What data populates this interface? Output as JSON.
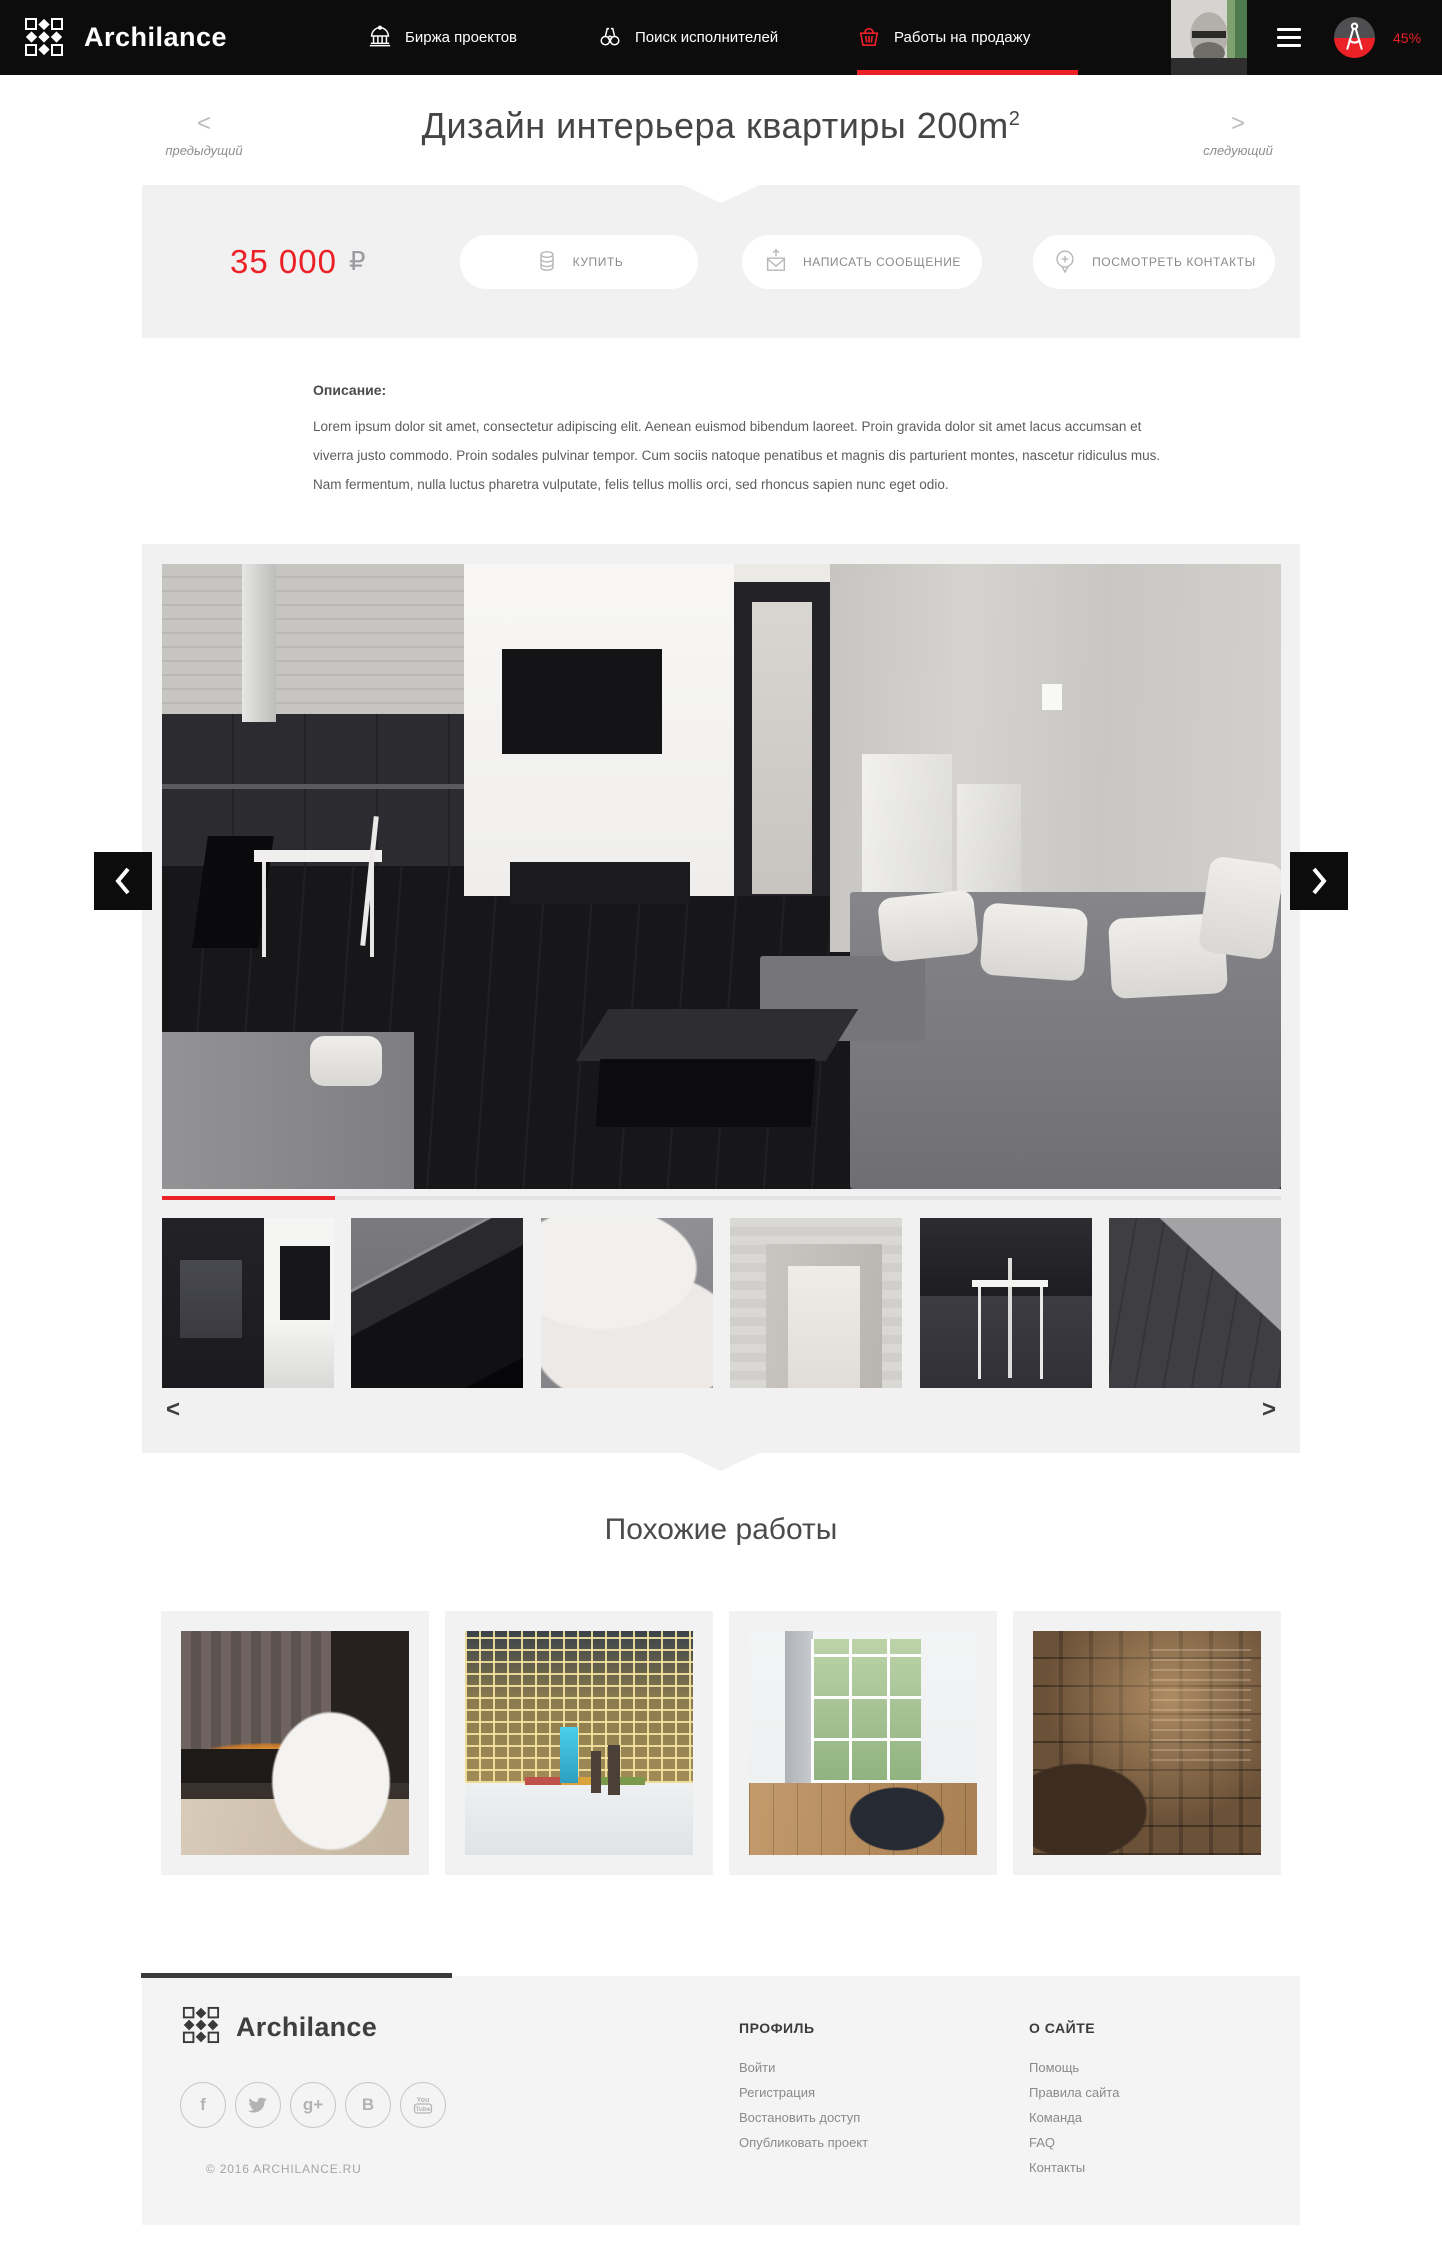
{
  "brand": {
    "name": "Archilance"
  },
  "navbar": {
    "items": [
      {
        "label": "Биржа проектов"
      },
      {
        "label": "Поиск исполнителей"
      },
      {
        "label": "Работы на продажу"
      }
    ],
    "percent": "45%"
  },
  "titlebar": {
    "title": "Дизайн интерьера квартиры 200m",
    "title_sup": "2",
    "prev_arrow": "<",
    "next_arrow": ">",
    "prev_label": "предыдущий",
    "next_label": "следующий"
  },
  "price": {
    "amount": "35 000",
    "currency": "₽"
  },
  "actions": {
    "buy": "КУПИТЬ",
    "message": "НАПИСАТЬ СООБЩЕНИЕ",
    "contacts": "ПОСМОТРЕТЬ КОНТАКТЫ"
  },
  "description": {
    "label": "Описание:",
    "text": "Lorem ipsum dolor sit amet, consectetur adipiscing elit. Aenean euismod bibendum laoreet. Proin gravida dolor sit amet lacus accumsan et viverra justo commodo. Proin sodales pulvinar tempor. Cum sociis natoque penatibus et magnis dis parturient montes, nascetur ridiculus mus. Nam fermentum, nulla luctus pharetra vulputate, felis tellus mollis orci, sed rhoncus sapien nunc eget odio."
  },
  "carousel": {
    "prev": "<",
    "next": ">"
  },
  "similar": {
    "heading": "Похожие работы"
  },
  "footer": {
    "brand": "Archilance",
    "copyright": "© 2016 ARCHILANCE.RU",
    "profile": {
      "heading": "ПРОФИЛЬ",
      "links": [
        "Войти",
        "Регистрация",
        "Востановить доступ",
        "Опубликовать проект"
      ]
    },
    "about": {
      "heading": "О САЙТЕ",
      "links": [
        "Помощь",
        "Правила сайта",
        "Команда",
        "FAQ",
        "Контакты"
      ]
    },
    "social": [
      {
        "name": "facebook",
        "glyph": "f"
      },
      {
        "name": "twitter",
        "glyph": ""
      },
      {
        "name": "google-plus",
        "glyph": "g+"
      },
      {
        "name": "vk",
        "glyph": "B"
      },
      {
        "name": "youtube",
        "glyph": ""
      }
    ]
  },
  "colors": {
    "accent": "#ec2127",
    "navbar_bg": "#0c0c0c",
    "section_gray": "#f1f1f1",
    "footer_gray": "#f4f4f4"
  }
}
